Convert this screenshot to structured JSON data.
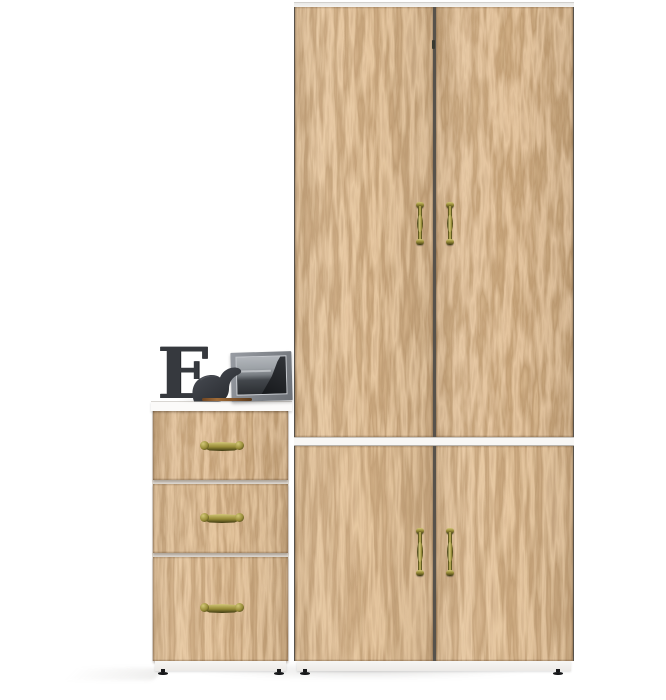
{
  "scene": {
    "type": "furniture-product-photo",
    "background": "#ffffff"
  },
  "decor": {
    "letter": "E",
    "items": [
      "decorative-letter-e",
      "elephant-figurine",
      "framed-seascape-photo",
      "wooden-pencil"
    ]
  },
  "furniture": {
    "wardrobe_doors": 4,
    "drawers": 3,
    "door_handles": 4,
    "drawer_handles": 3,
    "visible_feet": 4
  },
  "colors": {
    "bg": "#ffffff",
    "wood_base": "#c49263",
    "wood_dark": "#8f6a42",
    "wood_light": "#dab184",
    "seam": "#57524b",
    "edge_white": "#f2f1ef",
    "plinth_white": "#f6f5f3",
    "brass_hi": "#d3c878",
    "brass_mid": "#968a36",
    "brass_dark": "#3e3912",
    "decor_dark": "#36393e",
    "frame_gray": "#83878c",
    "foot": "#17181a"
  }
}
